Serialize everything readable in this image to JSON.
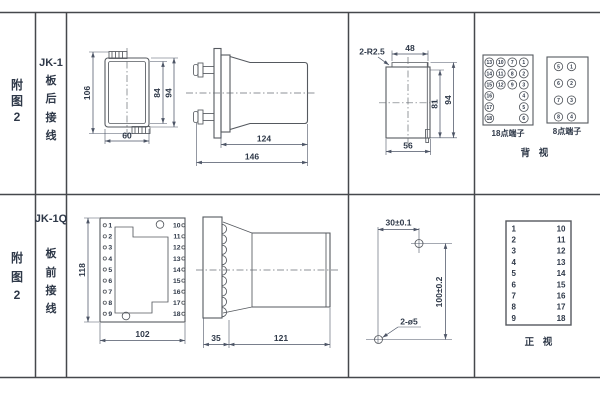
{
  "palette": {
    "line": "#55595f",
    "text": "#2e3848",
    "table_line": "#46484c",
    "background": "#ffffff"
  },
  "sidebar": {
    "row1": {
      "figure_chars": [
        "附",
        "图",
        "2"
      ],
      "model": "JK-1",
      "wiring_chars": [
        "板",
        "后",
        "接",
        "线"
      ]
    },
    "row2": {
      "figure_chars": [
        "附",
        "图",
        "2"
      ],
      "model": "JK-1Q",
      "wiring_chars": [
        "板",
        "前",
        "接",
        "线"
      ]
    }
  },
  "rear_section": {
    "front_outline": {
      "dim_height_overall": "106",
      "dim_height_inner": "84",
      "dim_height_outer": "94",
      "dim_width": "60"
    },
    "side_view": {
      "dim_body_depth": "124",
      "dim_total_depth": "146"
    },
    "cutout": {
      "corner_radius": "2-R2.5",
      "dim_top_width": "48",
      "dim_inner_height": "81",
      "dim_outer_height": "94",
      "dim_bottom_width": "56"
    },
    "terminals_18": {
      "label": "18点端子",
      "grid": [
        [
          "13",
          "10",
          "7",
          "1"
        ],
        [
          "14",
          "11",
          "8",
          "2"
        ],
        [
          "15",
          "12",
          "9",
          "3"
        ],
        [
          "16",
          "4"
        ],
        [
          "17",
          "5"
        ],
        [
          "18",
          "6"
        ]
      ]
    },
    "terminals_8": {
      "label": "8点端子",
      "grid": [
        [
          "5",
          "1"
        ],
        [
          "6",
          "2"
        ],
        [
          "7",
          "3"
        ],
        [
          "8",
          "4"
        ]
      ]
    },
    "view_label": "背 视"
  },
  "front_section": {
    "panel": {
      "left_terminals": [
        "1",
        "2",
        "3",
        "4",
        "5",
        "6",
        "7",
        "8",
        "9"
      ],
      "right_terminals": [
        "10",
        "11",
        "12",
        "13",
        "14",
        "15",
        "16",
        "17",
        "18"
      ],
      "dim_height": "118",
      "dim_width": "102"
    },
    "side_view": {
      "dim_flange": "35",
      "dim_body": "121"
    },
    "drill_plan": {
      "dim_horizontal": "30±0.1",
      "dim_vertical": "100±0.2",
      "holes_label": "2-ø5"
    },
    "terminal_box": {
      "left": [
        "1",
        "2",
        "3",
        "4",
        "5",
        "6",
        "7",
        "8",
        "9"
      ],
      "right": [
        "10",
        "11",
        "12",
        "13",
        "14",
        "15",
        "16",
        "17",
        "18"
      ],
      "view_label": "正 视"
    }
  }
}
